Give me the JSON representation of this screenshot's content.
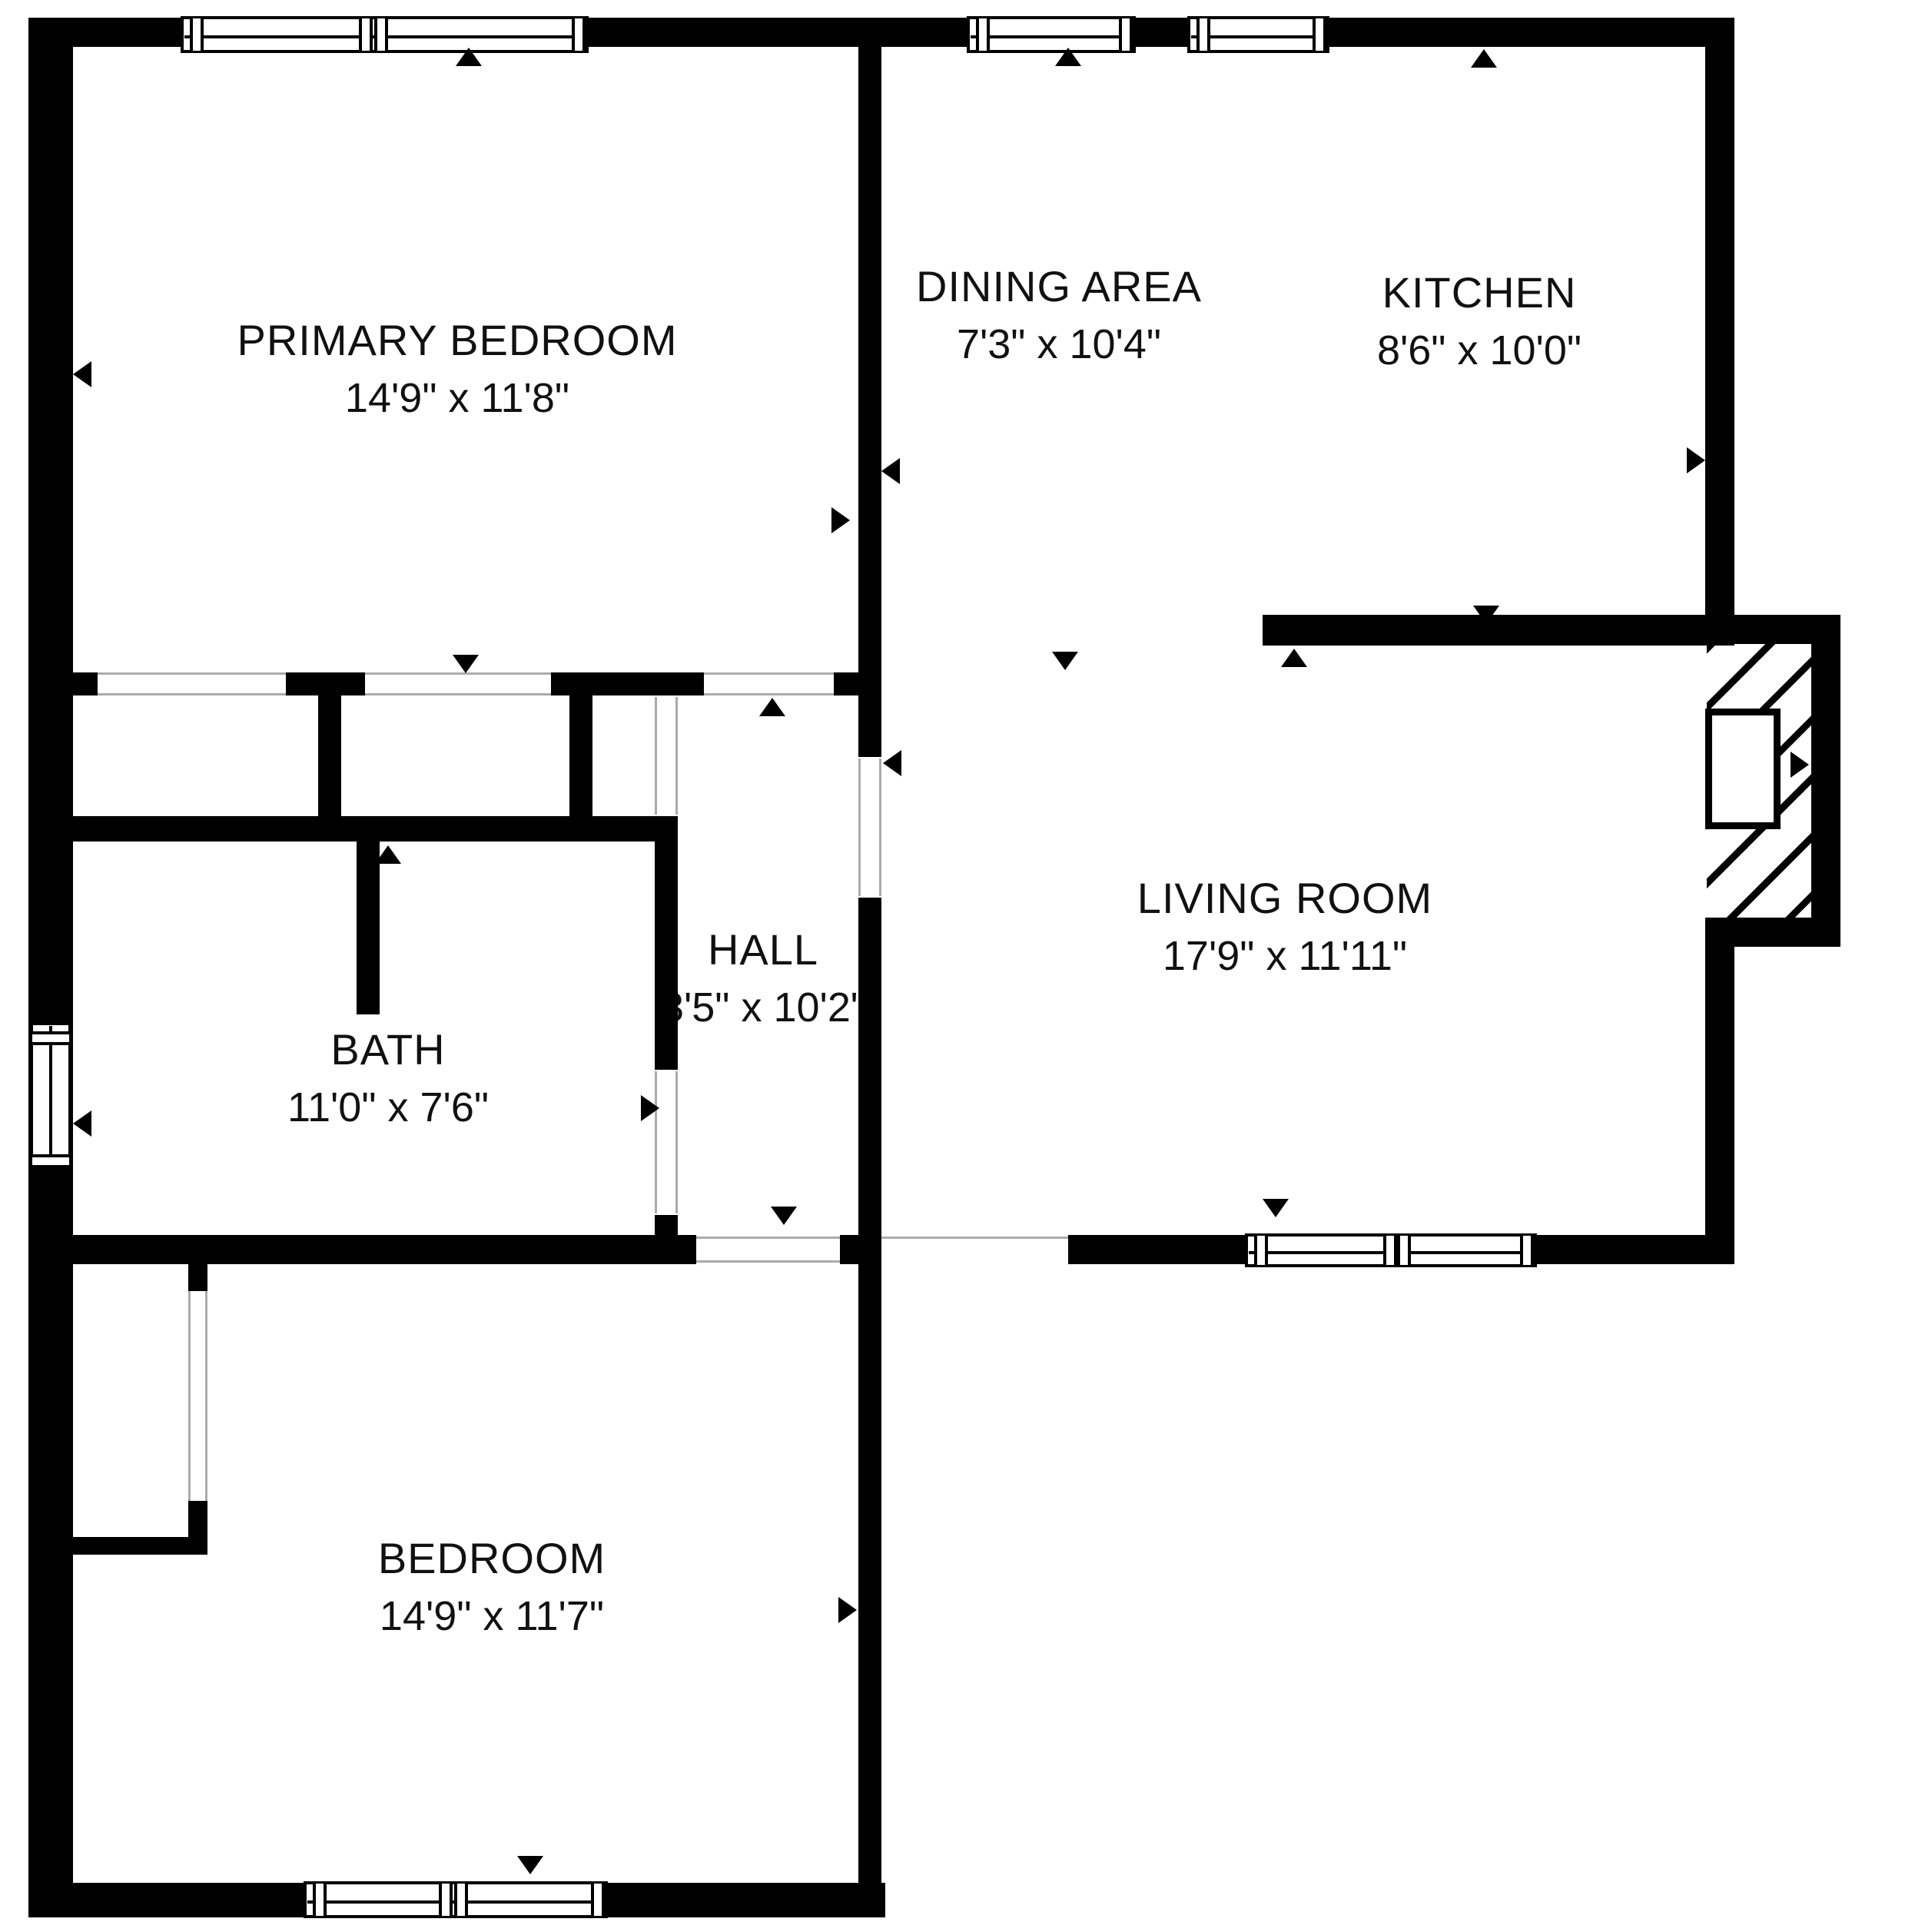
{
  "plan": {
    "type": "residential floor plan",
    "background": "#ffffff",
    "wall_color": "#000000",
    "text_color": "#111111",
    "opening_line_color": "#ababab"
  },
  "rooms": [
    {
      "id": "primary-bedroom",
      "name": "PRIMARY BEDROOM",
      "dims": "14'9\" x 11'8\""
    },
    {
      "id": "dining-area",
      "name": "DINING AREA",
      "dims": "7'3\" x 10'4\""
    },
    {
      "id": "kitchen",
      "name": "KITCHEN",
      "dims": "8'6\" x 10'0\""
    },
    {
      "id": "living-room",
      "name": "LIVING ROOM",
      "dims": "17'9\" x 11'11\""
    },
    {
      "id": "hall",
      "name": "HALL",
      "dims": "3'5\" x 10'2\""
    },
    {
      "id": "bath",
      "name": "BATH",
      "dims": "11'0\" x 7'6\""
    },
    {
      "id": "bedroom",
      "name": "BEDROOM",
      "dims": "14'9\" x 11'7\""
    }
  ]
}
